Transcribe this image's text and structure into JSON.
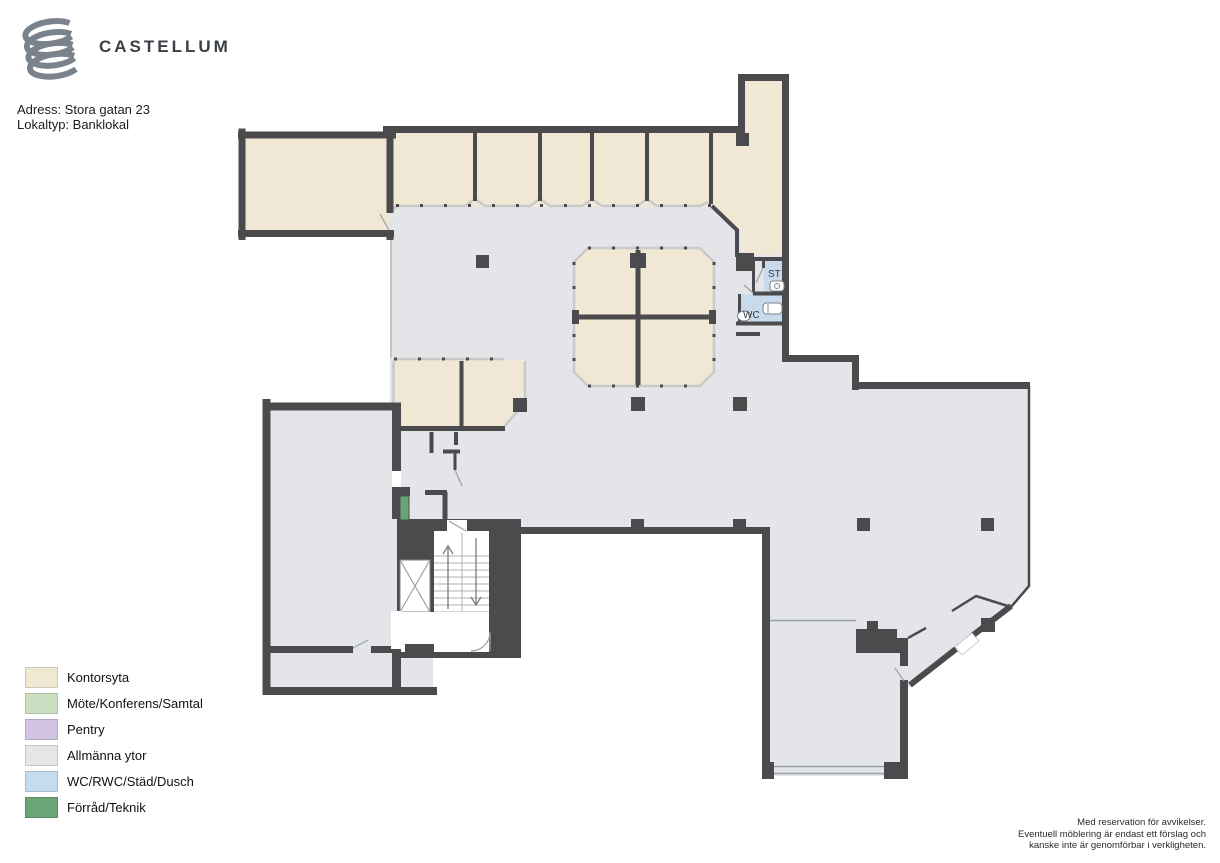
{
  "header": {
    "brand": "CASTELLUM",
    "address_line": "Adress: Stora gatan 23",
    "type_line": "Lokaltyp: Banklokal"
  },
  "plan": {
    "room_labels": {
      "st": "ST",
      "wc": "WC"
    },
    "colors": {
      "wall": "#4b4b4d",
      "office": "#f0e8d4",
      "common": "#e3e5e8",
      "wet_room": "#c7dbec",
      "storage": "#6ba476",
      "glass_partition": "#c8cac7"
    }
  },
  "legend": {
    "items": [
      {
        "label": "Kontorsyta",
        "color": "#efe8d3"
      },
      {
        "label": "Möte/Konferens/Samtal",
        "color": "#c9dfc2"
      },
      {
        "label": "Pentry",
        "color": "#d2c5e2"
      },
      {
        "label": "Allmänna ytor",
        "color": "#e4e6e8"
      },
      {
        "label": "WC/RWC/Städ/Dusch",
        "color": "#c4dcf0"
      },
      {
        "label": "Förråd/Teknik",
        "color": "#6ba476"
      }
    ]
  },
  "footer": {
    "disclaimer": [
      "Med reservation för avvikelser.",
      "Eventuell möblering är endast ett förslag och",
      "kanske inte är genomförbar i verkligheten."
    ]
  }
}
